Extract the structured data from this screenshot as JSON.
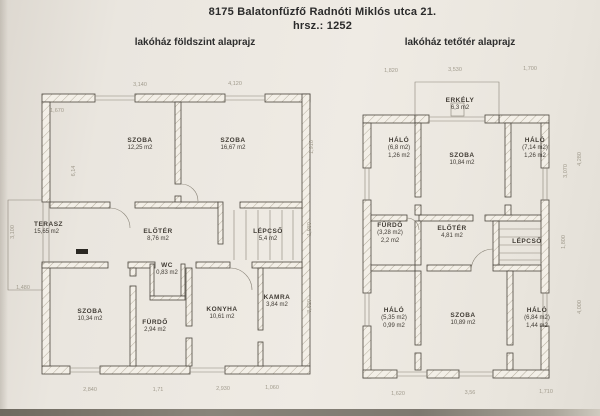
{
  "header": {
    "address": "8175 Balatonfűzfő Radnóti Miklós utca 21.",
    "parcel": "hrsz.: 1252"
  },
  "plans": {
    "ground": {
      "title": "lakóház földszint alaprajz",
      "rooms": [
        {
          "name": "SZOBA",
          "area": "12,25 m2"
        },
        {
          "name": "SZOBA",
          "area": "16,67 m2"
        },
        {
          "name": "TERASZ",
          "area": "15,65 m2"
        },
        {
          "name": "ELŐTÉR",
          "area": "8,76 m2"
        },
        {
          "name": "LÉPCSŐ",
          "area": "5,4 m2"
        },
        {
          "name": "WC",
          "area": "0,83 m2"
        },
        {
          "name": "SZOBA",
          "area": "10,34 m2"
        },
        {
          "name": "FÜRDŐ",
          "area": "2,94 m2"
        },
        {
          "name": "KONYHA",
          "area": "10,61 m2"
        },
        {
          "name": "KAMRA",
          "area": "3,84 m2"
        }
      ],
      "dims": {
        "top_1": "3,140",
        "top_2": "4,120",
        "upper_left": "1,670",
        "left_mid": "6,14",
        "terasz_left": "3,100",
        "terasz_bottom": "1,480",
        "right_1": "1,910",
        "right_2": "1,930",
        "right_3": "3,620",
        "bottom_1": "2,840",
        "bottom_2": "1,71",
        "bottom_3": "2,930",
        "bottom_4": "1,060"
      }
    },
    "attic": {
      "title": "lakóház tetőtér alaprajz",
      "rooms": [
        {
          "name": "ERKÉLY",
          "area": "6,3 m2"
        },
        {
          "name": "HÁLÓ",
          "area": "(6,8 m2)",
          "area2": "1,26 m2"
        },
        {
          "name": "SZOBA",
          "area": "10,84 m2"
        },
        {
          "name": "HÁLÓ",
          "area": "(7,14 m2)",
          "area2": "1,26 m2"
        },
        {
          "name": "FÜRDŐ",
          "area": "(3,28 m2)",
          "area2": "2,2 m2"
        },
        {
          "name": "ELŐTÉR",
          "area": "4,81 m2"
        },
        {
          "name": "LÉPCSŐ"
        },
        {
          "name": "HÁLÓ",
          "area": "(5,35 m2)",
          "area2": "0,99 m2"
        },
        {
          "name": "SZOBA",
          "area": "10,89 m2"
        },
        {
          "name": "HÁLÓ",
          "area": "(6,84 m2)",
          "area2": "1,44 m2"
        }
      ],
      "dims": {
        "top_1": "1,820",
        "top_2": "3,530",
        "top_3": "1,700",
        "right_inner": "3,070",
        "right_outer": "4,280",
        "right_mid": "1,800",
        "right_lower": "4,000",
        "bottom_1": "1,620",
        "bottom_2": "3,56",
        "bottom_3": "1,710"
      }
    }
  }
}
